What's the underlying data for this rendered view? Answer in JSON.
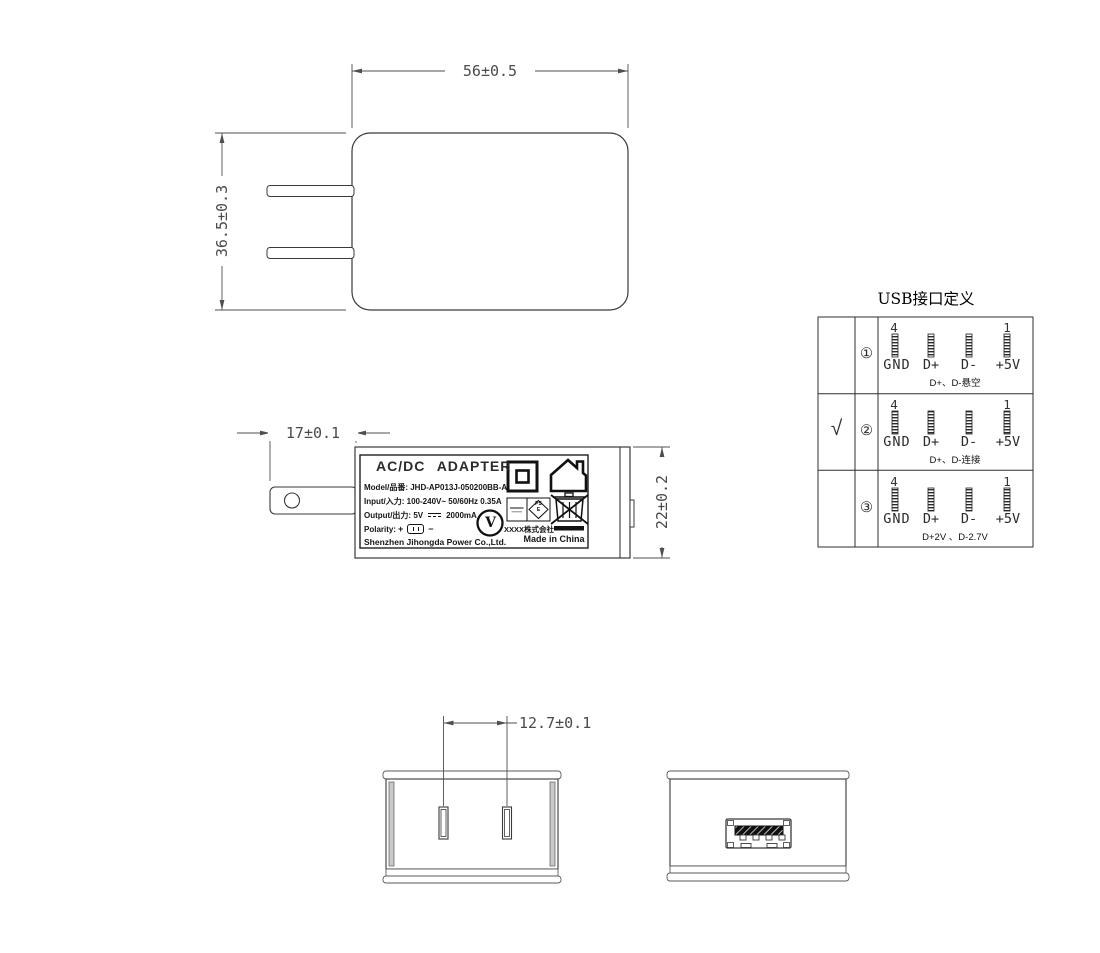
{
  "dimensions": {
    "body_width": "56±0.5",
    "body_height": "36.5±0.3",
    "prong_length": "17±0.1",
    "body_thickness": "22±0.2",
    "pin_pitch": "12.7±0.1"
  },
  "label": {
    "title": "AC/DC ADAPTER",
    "model_line": "Model/品番: JHD-AP013J-050200BB-A",
    "input_line": "Input/入力: 100-240V~  50/60Hz  0.35A",
    "output_prefix": "Output/出力: 5V",
    "output_suffix": "2000mA",
    "polarity_label": "Polarity:",
    "polarity_plus": "+",
    "polarity_minus": "−",
    "company": "Shenzhen Jihongda Power Co.,Ltd.",
    "efficiency_mark": "V",
    "pse_mark_top": "PS",
    "pse_mark_bottom": "E",
    "maker": "XXXX株式会社",
    "origin": "Made in China"
  },
  "usb_table": {
    "title": "USB接口定义",
    "pin_first": "4",
    "pin_last": "1",
    "rows": [
      {
        "mark": "",
        "num": "①",
        "pins": [
          "GND",
          "D+",
          "D-",
          "+5V"
        ],
        "caption": "D+、D-悬空"
      },
      {
        "mark": "√",
        "num": "②",
        "pins": [
          "GND",
          "D+",
          "D-",
          "+5V"
        ],
        "caption": "D+、D-连接"
      },
      {
        "mark": "",
        "num": "③",
        "pins": [
          "GND",
          "D+",
          "D-",
          "+5V"
        ],
        "caption": "D+2V 、D-2.7V"
      }
    ]
  }
}
